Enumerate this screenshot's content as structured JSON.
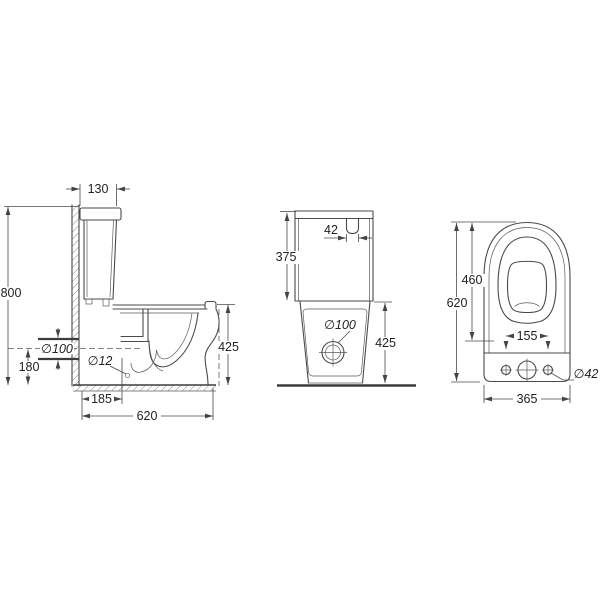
{
  "colors": {
    "line": "#4a4a4a",
    "background": "#ffffff",
    "text": "#222222"
  },
  "drawing": {
    "side_view": {
      "tank_depth_top": "130",
      "total_height": "800",
      "outlet_diameter": "∅100",
      "outlet_center_height": "180",
      "fixing_hole_diameter": "∅12",
      "wall_to_fixing": "185",
      "total_depth": "620",
      "bowl_height": "425"
    },
    "front_view": {
      "flush_button_width": "42",
      "tank_height": "375",
      "outlet_diameter": "∅100",
      "bowl_height": "425"
    },
    "top_view": {
      "seat_length": "460",
      "total_length": "620",
      "fixing_hole_spacing": "155",
      "side_hole_diameter": "∅42",
      "total_width": "365"
    }
  }
}
